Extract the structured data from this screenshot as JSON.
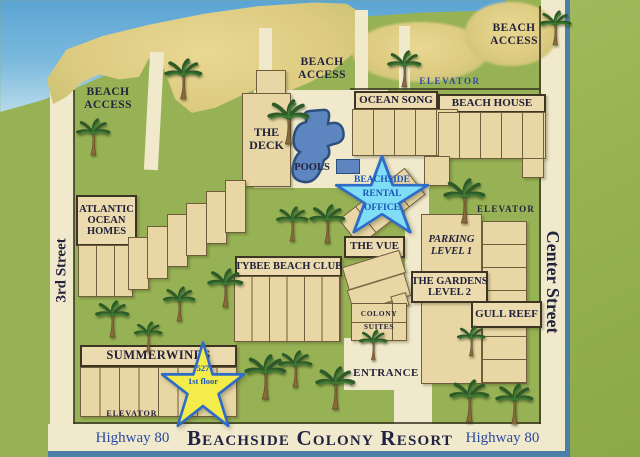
{
  "title": "Beachside Colony Resort",
  "streets": {
    "left": "3rd Street",
    "right": "Center Street",
    "highway_left": "Highway 80",
    "highway_right": "Highway 80"
  },
  "beach_access": {
    "line1": "BEACH",
    "line2": "ACCESS"
  },
  "elevator_top": "ELEVATOR",
  "elevator_right": "ELEVATOR",
  "elevator_bottom": "ELEVATOR",
  "entrance": "ENTRANCE",
  "buildings": {
    "ocean_song": "OCEAN SONG",
    "beach_house": "BEACH HOUSE",
    "deck": {
      "line1": "THE",
      "line2": "DECK"
    },
    "pools_label": "POOLS",
    "atlantic": {
      "line1": "ATLANTIC",
      "line2": "OCEAN",
      "line3": "HOMES"
    },
    "vue": "THE VUE",
    "tybee": "TYBEE BEACH CLUB",
    "parking": {
      "line1": "PARKING",
      "line2": "LEVEL 1"
    },
    "gardens": {
      "line1": "THE GARDENS",
      "line2": "LEVEL 2"
    },
    "gull_reef": "GULL REEF",
    "colony": {
      "line1": "COLONY",
      "line2": "SUITES"
    },
    "summerwinds": "SUMMERWINDS"
  },
  "office_star": {
    "line1": "BEACHSIDE",
    "line2": "RENTAL",
    "line3": "OFFICE"
  },
  "unit_star": {
    "number": "527",
    "floor": "1st floor"
  },
  "colors": {
    "grass": "#97b254",
    "sand": "#ddcb81",
    "road": "#f1e9cb",
    "building_tan": "#e8d6a4",
    "pool_blue": "#5d86c0",
    "office_star_fill": "#7fdef5",
    "unit_star_fill": "#f4ec49",
    "star_outline": "#2f6cc8",
    "blue_text": "#2b4aa0",
    "dark_text": "#23233d",
    "border_blue": "#4a7fa8"
  }
}
